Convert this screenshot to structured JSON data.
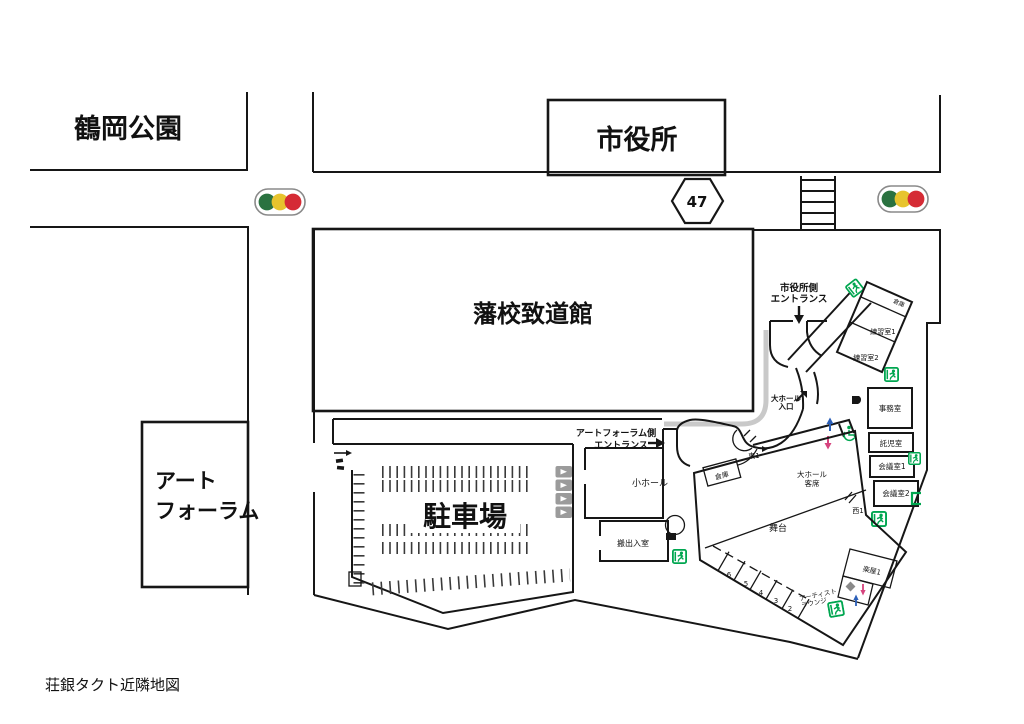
{
  "colors": {
    "line": "#161616",
    "signal_green": "#2a7240",
    "signal_yellow": "#e7c42e",
    "signal_red": "#d52b35",
    "exit_green": "#00a650",
    "path_gray": "#c9c9c9",
    "arrow_blue": "#2b5fb8",
    "arrow_pink": "#d6447e",
    "sign_gray": "#9b9b9b"
  },
  "map": {
    "caption": "荘銀タクト近隣地図",
    "roads": {
      "route_number": "47"
    },
    "landmarks": {
      "park": "鶴岡公園",
      "city_hall": "市役所",
      "hanko_chidokan": "藩校致道館",
      "art_forum": [
        "アート",
        "フォーラム"
      ],
      "parking": "駐車場"
    },
    "entrances": {
      "city_hall_side": [
        "市役所側",
        "エントランス"
      ],
      "art_forum_side": [
        "アートフォーラム側",
        "エントランス"
      ],
      "main_hall": [
        "大ホール",
        "入口"
      ]
    },
    "facility": {
      "small_hall": "小ホール",
      "loading_room": "搬出入室",
      "stage": "舞台",
      "main_hall_seats": [
        "大ホール",
        "客席"
      ],
      "office": "事務室",
      "nursery": "託児室",
      "meeting_room_1": "会議室1",
      "meeting_room_2": "会議室2",
      "practice_room_1": "練習室1",
      "practice_room_2": "練習室2",
      "storage_north": "倉庫",
      "storage_lobby": "倉庫",
      "dressing_room_1": "楽屋1",
      "artist_lounge": [
        "アーティスト",
        "ラウンジ"
      ],
      "door_east_1": "東1",
      "door_west_1": "西1",
      "room_numbers": [
        "6",
        "5",
        "4",
        "3",
        "2"
      ]
    },
    "icons": {
      "traffic_signal": "traffic-signal",
      "crosswalk": "crosswalk",
      "route_shield": "route-47-shield",
      "emergency_exit": "emergency-exit-running-man",
      "wheelchair": "wheelchair-access",
      "stairs_up": "up-arrow-blue",
      "stairs_down": "down-arrow-pink",
      "elevator": "elevator",
      "piano": "grand-piano"
    }
  }
}
